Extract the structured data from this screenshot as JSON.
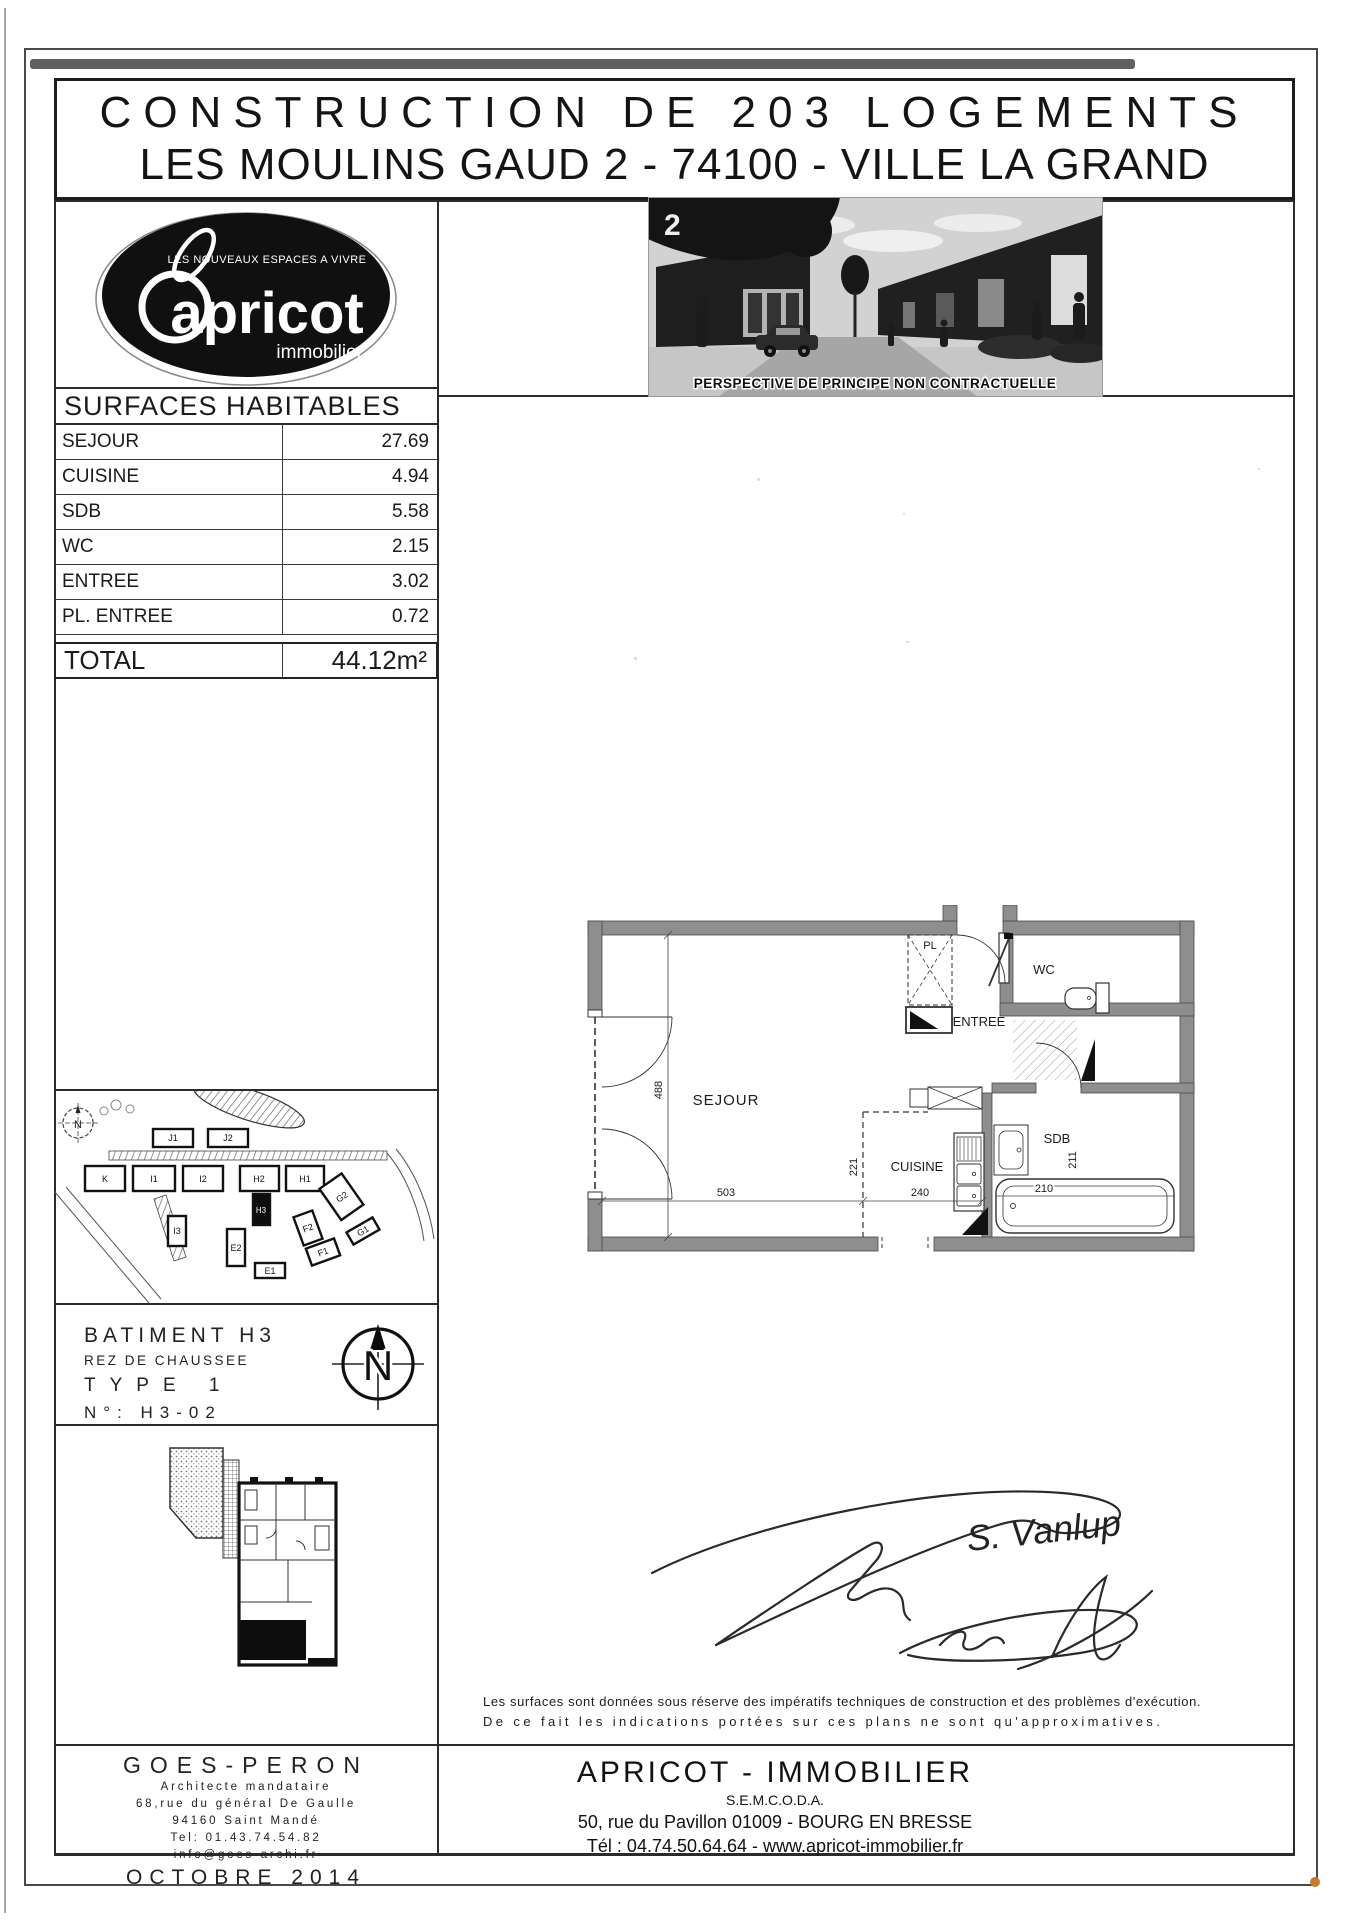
{
  "title": {
    "line1": "CONSTRUCTION DE 203 LOGEMENTS",
    "line2": "LES MOULINS GAUD 2 - 74100 - VILLE LA GRAND"
  },
  "logo": {
    "tagline": "LES NOUVEAUX ESPACES A VIVRE",
    "name": "apricot",
    "subname": "immobilier"
  },
  "perspective": {
    "corner_number": "2",
    "caption": "PERSPECTIVE DE PRINCIPE NON CONTRACTUELLE"
  },
  "surfaces": {
    "header": "SURFACES HABITABLES",
    "rows": [
      {
        "label": "SEJOUR",
        "value": "27.69"
      },
      {
        "label": "CUISINE",
        "value": "4.94"
      },
      {
        "label": "SDB",
        "value": "5.58"
      },
      {
        "label": "WC",
        "value": "2.15"
      },
      {
        "label": "ENTREE",
        "value": "3.02"
      },
      {
        "label": "PL. ENTREE",
        "value": "0.72"
      }
    ],
    "total_label": "TOTAL",
    "total_value": "44.12m²"
  },
  "site_plan": {
    "compass": "N",
    "buildings": [
      "J1",
      "J2",
      "K",
      "I1",
      "I2",
      "H2",
      "H1",
      "H3",
      "G2",
      "I3",
      "E2",
      "F2",
      "G1",
      "F1",
      "E1"
    ]
  },
  "unit": {
    "building": "BATIMENT H3",
    "floor": "REZ DE CHAUSSEE",
    "type": "TYPE 1",
    "number": "N°: H3-02",
    "compass": "N"
  },
  "floor_plan": {
    "labels": {
      "sejour": "SEJOUR",
      "cuisine": "CUISINE",
      "sdb": "SDB",
      "wc": "WC",
      "entree": "ENTREE",
      "pl": "PL"
    },
    "dims": {
      "sejour_h": "488",
      "sejour_w": "503",
      "cuisine_h": "221",
      "cuisine_w": "240",
      "sdb_w": "210",
      "sdb_h": "211"
    }
  },
  "signature": {
    "name": "S. Vanlup"
  },
  "disclaimer": {
    "line1": "Les surfaces sont données sous réserve des impératifs techniques de construction et des problèmes d'exécution.",
    "line2": "De ce fait les indications portées sur ces plans ne sont qu'approximatives."
  },
  "footer": {
    "architect": {
      "name": "GOES-PERON",
      "role": "Architecte mandataire",
      "address1": "68,rue du général De Gaulle",
      "address2": "94160 Saint Mandé",
      "tel": "Tel: 01.43.74.54.82",
      "email": "info@goes-archi.fr",
      "date": "OCTOBRE 2014"
    },
    "promoter": {
      "name": "APRICOT - IMMOBILIER",
      "org": "S.E.M.C.O.D.A.",
      "address": "50, rue du Pavillon 01009 - BOURG EN BRESSE",
      "tel": "Tél : 04.74.50.64.64 - www.apricot-immobilier.fr"
    }
  }
}
